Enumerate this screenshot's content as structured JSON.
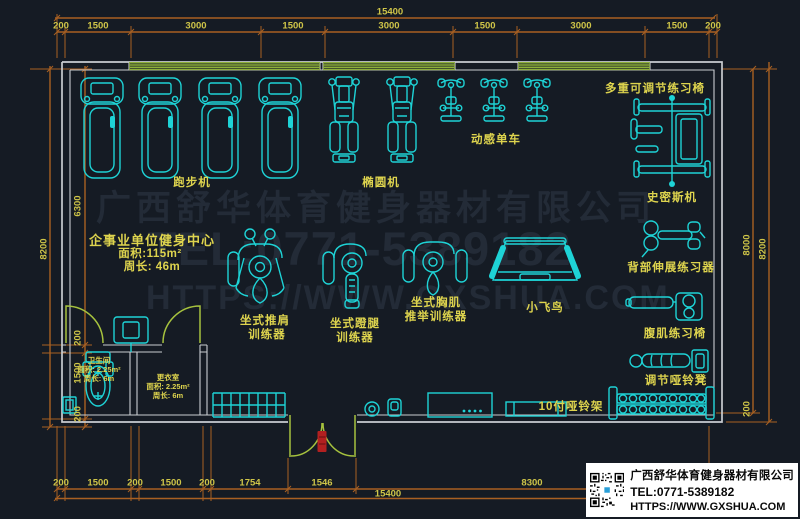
{
  "plan": {
    "info_center": {
      "title": "企事业单位健身中心",
      "area": "面积:115m²",
      "perimeter": "周长: 46m"
    },
    "bathroom": {
      "name": "卫生间",
      "area": "面积: 2.25m²",
      "perimeter": "周长: 6m"
    },
    "changing_room": {
      "name": "更衣室",
      "area": "面积: 2.25m²",
      "perimeter": "周长: 6m"
    },
    "equipment": {
      "treadmill": "跑步机",
      "elliptical": "椭圆机",
      "spin_bike": "动感单车",
      "multi_adjustable_chair": "多重可调节练习椅",
      "smith_machine": "史密斯机",
      "back_extension": "背部伸展练习器",
      "ab_chair": "腹肌练习椅",
      "adjustable_dumbbell_bench": "调节哑铃凳",
      "dumbbell_rack": "10付哑铃架",
      "fly_bird": "小飞鸟",
      "shoulder_press_1": "坐式推肩",
      "shoulder_press_2": "训练器",
      "leg_press_1": "坐式蹬腿",
      "leg_press_2": "训练器",
      "chest_press_1": "坐式胸肌",
      "chest_press_2": "推举训练器"
    }
  },
  "dimensions": {
    "top_total": "15400",
    "top_segments": [
      "200",
      "1500",
      "3000",
      "1500",
      "3000",
      "1500",
      "3000",
      "1500",
      "200"
    ],
    "bottom_segments": [
      "200",
      "1500",
      "200",
      "1500",
      "200",
      "1754",
      "1546",
      "8300"
    ],
    "bottom_total": "15400",
    "left_outer": "8200",
    "left_segments": [
      "6300",
      "200",
      "1500",
      "200"
    ],
    "right_inner": "8000",
    "right_outer": "8200",
    "right_bottom": "200"
  },
  "watermark": {
    "line1": "广西舒华体育健身器材有限公司",
    "line2": "TEL:0771-5389182",
    "line3": "HTTPS://WWW.GXSHUA.COM"
  },
  "title_block": {
    "company": "广西舒华体育健身器材有限公司",
    "tel": "TEL:0771-5389182",
    "website": "HTTPS://WWW.GXSHUA.COM"
  },
  "colors": {
    "background": "#151b24",
    "equipment": "#1ed3d6",
    "wall": "#c9cdd1",
    "dimension_line": "#a96022",
    "dimension_text": "#cfc548",
    "label_text": "#ded44e",
    "window": "#8fb03a",
    "door": "#a6c23e",
    "accent_red": "#b32020",
    "watermark": "#232b37"
  }
}
